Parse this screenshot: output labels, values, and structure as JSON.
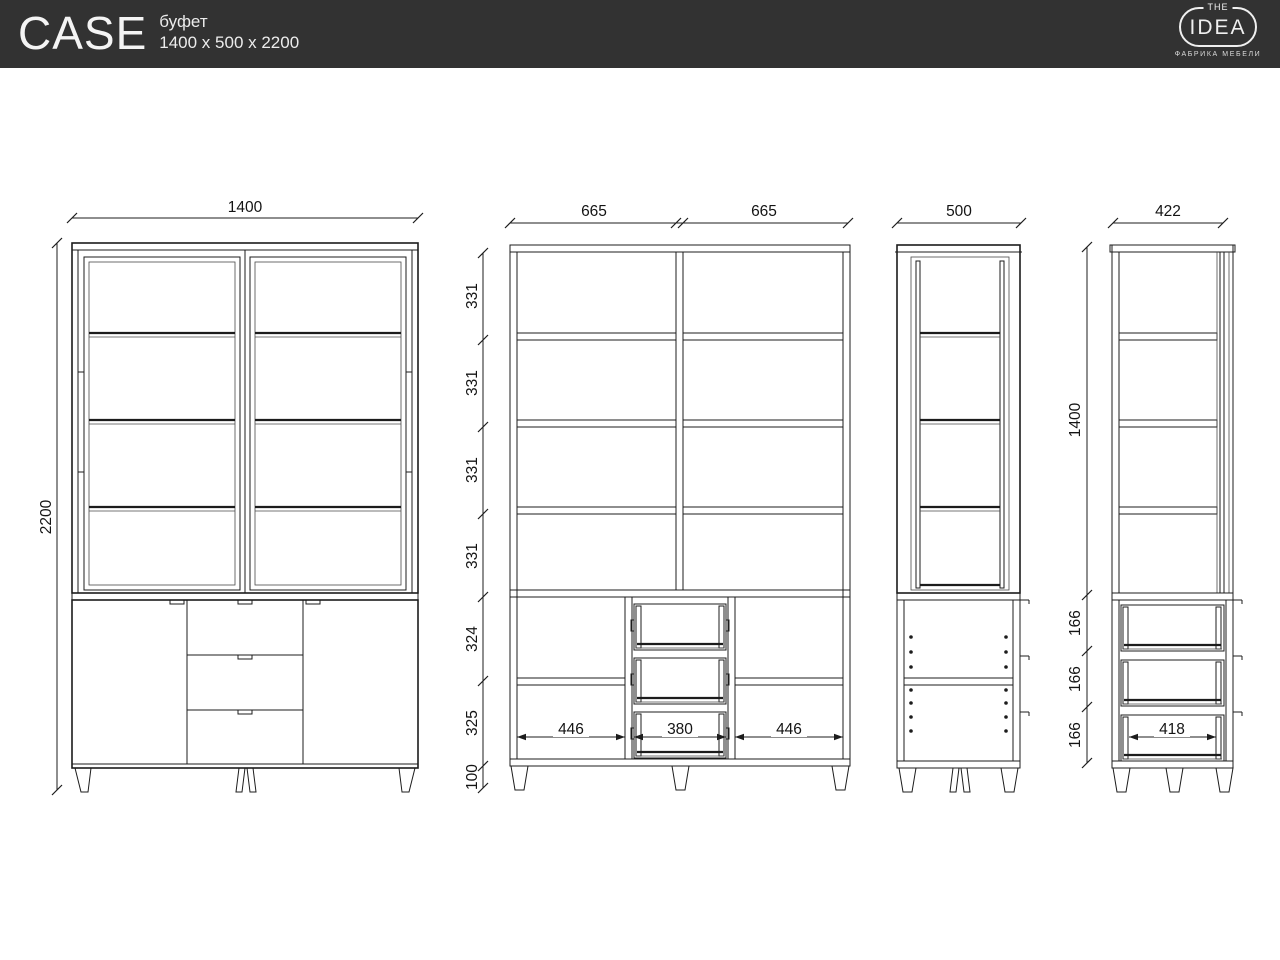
{
  "header": {
    "title": "CASE",
    "subtitle": "буфет",
    "size": "1400 x 500 x 2200",
    "bg_color": "#323232",
    "logo": {
      "the": "THE",
      "idea": "IDEA",
      "tagline": "ФАБРИКА МЕБЕЛИ"
    }
  },
  "dims": {
    "front": {
      "width": "1400",
      "height": "2200"
    },
    "front_section": {
      "left_width": "665",
      "right_width": "665",
      "shelf_gaps": [
        "331",
        "331",
        "331",
        "331"
      ],
      "lower": [
        "324",
        "325",
        "100"
      ],
      "inner": [
        "446",
        "380",
        "446"
      ]
    },
    "side": {
      "depth": "500"
    },
    "side_section": {
      "depth": "422",
      "upper_height": "1400",
      "drawers": [
        "166",
        "166",
        "166"
      ],
      "drawer_width": "418"
    }
  },
  "drawing": {
    "line_color": "#1c1c1c",
    "hatch_color": "#9a9a9a"
  }
}
